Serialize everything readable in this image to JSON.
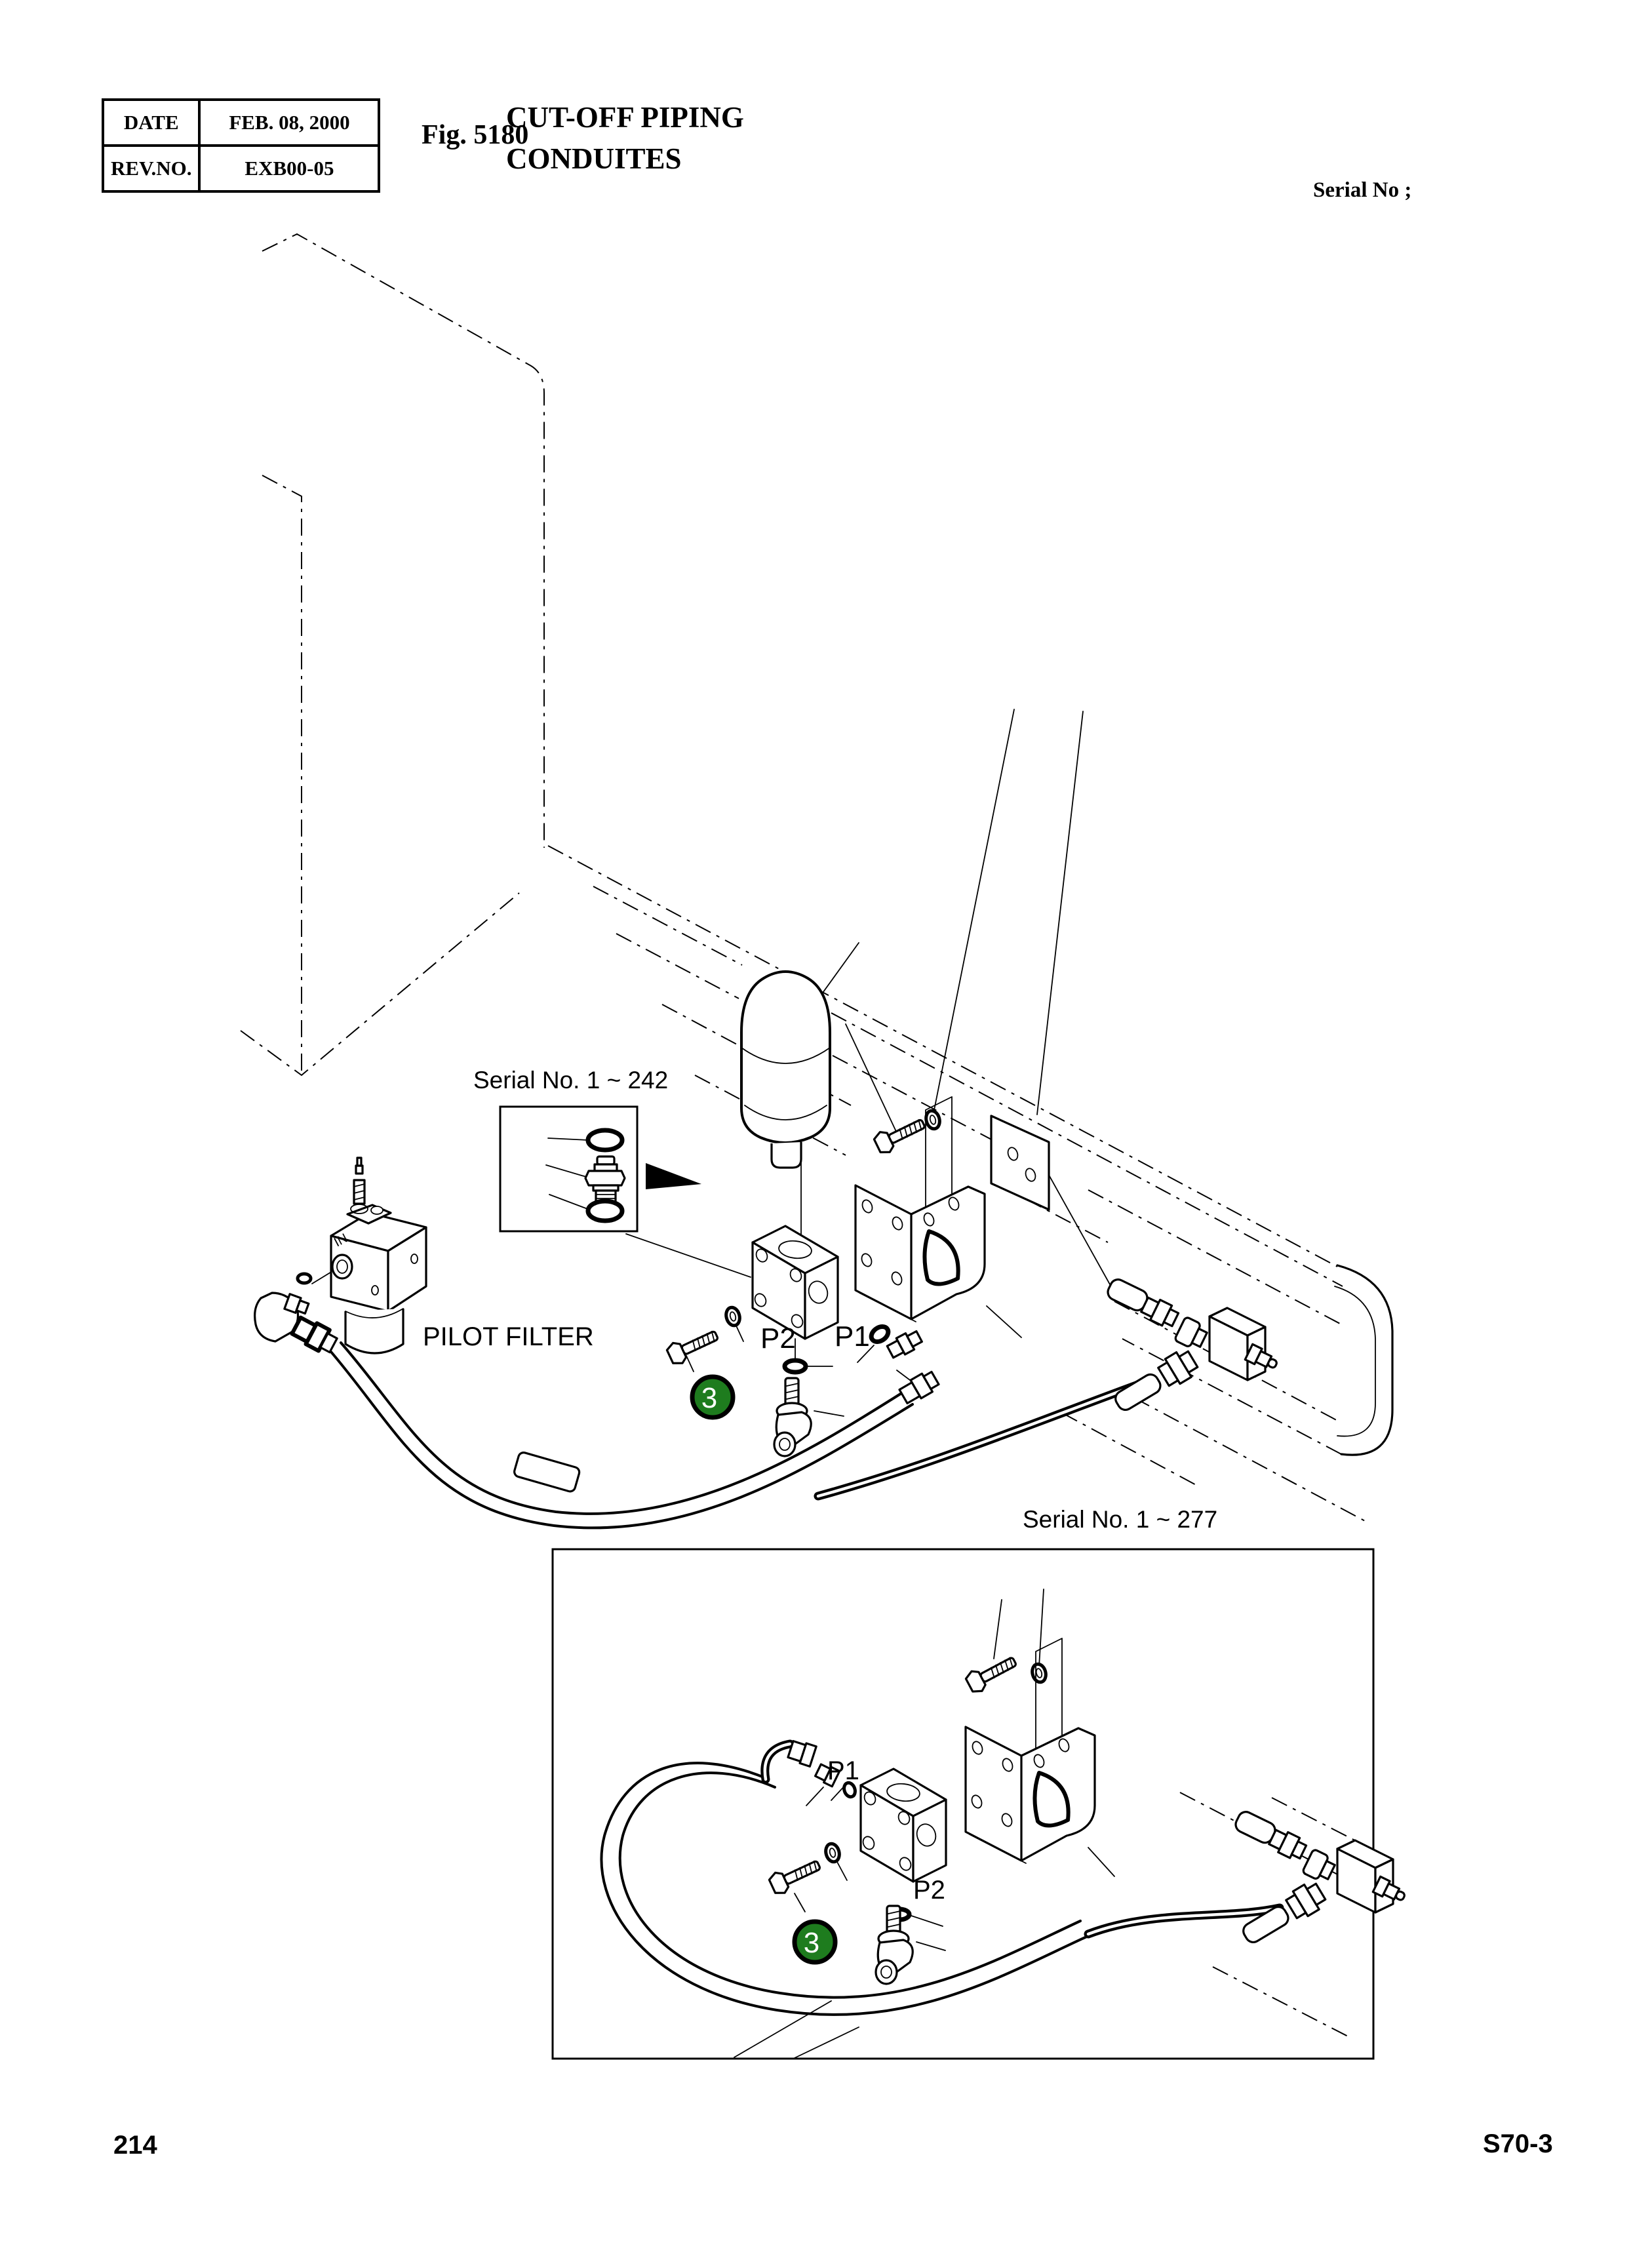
{
  "header": {
    "table": {
      "rows": [
        [
          "DATE",
          "FEB. 08, 2000"
        ],
        [
          "REV.NO.",
          "EXB00-05"
        ]
      ]
    },
    "figure_label": "Fig. 5180",
    "title_lines": [
      "CUT-OFF PIPING",
      "CONDUITES"
    ],
    "serial_label": "Serial No ;"
  },
  "diagram_upper": {
    "inset_caption": "Serial No. 1 ~ 242",
    "filter_caption": "PILOT FILTER",
    "filter_marking": "IN",
    "port_p2": "P2",
    "port_p1": "P1",
    "callout": "3"
  },
  "diagram_lower": {
    "caption": "Serial No. 1 ~ 277",
    "port_p1": "P1",
    "port_p2": "P2",
    "callout": "3"
  },
  "footer": {
    "page_number": "214",
    "doc_code": "S70-3"
  },
  "colors": {
    "callout_green": "#1e7c1e",
    "ink": "#000000",
    "paper": "#ffffff"
  }
}
